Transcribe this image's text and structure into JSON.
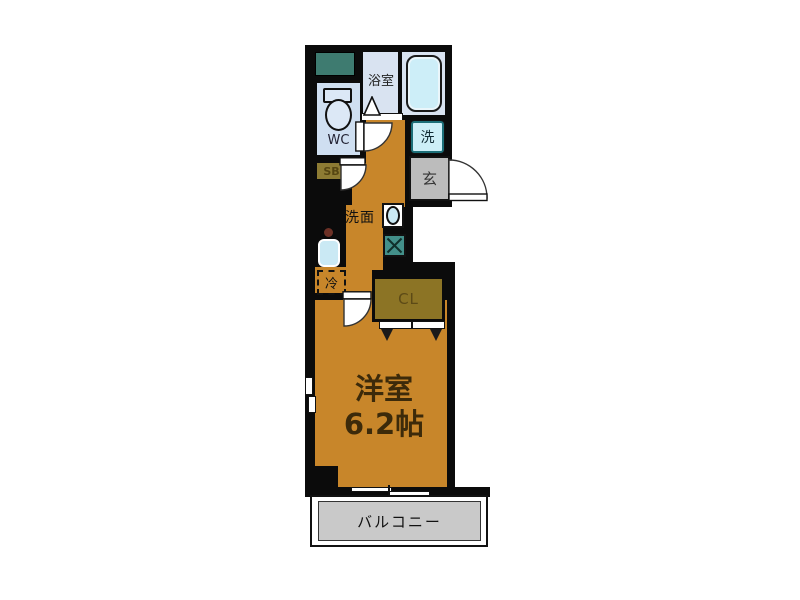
{
  "figure": "apartment-floor-plan",
  "rooms": {
    "bathroom": "浴室",
    "wc": "WC",
    "washer": "洗",
    "entrance": "玄",
    "shoe_box": "SB",
    "washstand": "洗面",
    "refrigerator": "冷",
    "closet": "CL",
    "western_room": "洋室",
    "western_room_size": "6.2帖",
    "balcony": "バルコニー"
  },
  "colors": {
    "wall": "#0b0b0b",
    "floor_orange": "#c8862a",
    "bathroom_blue": "#d9e3f1",
    "bathtub_cyan": "#cdeef8",
    "wc_blue": "#cfdff1",
    "washer_cyan": "#cdeff7",
    "washer_border_teal": "#1d6f78",
    "entrance_gray": "#bcbcbc",
    "shoe_box_olive": "#8d7b33",
    "closet_olive": "#8c7425",
    "utility_teal": "#3e7b70",
    "vent_unit_teal": "#43908a",
    "balcony_gray": "#c9c9c9",
    "room_text_brown": "#3c2a0a",
    "sink_blue": "#cae9f4",
    "burner_brown": "#6d3126"
  }
}
